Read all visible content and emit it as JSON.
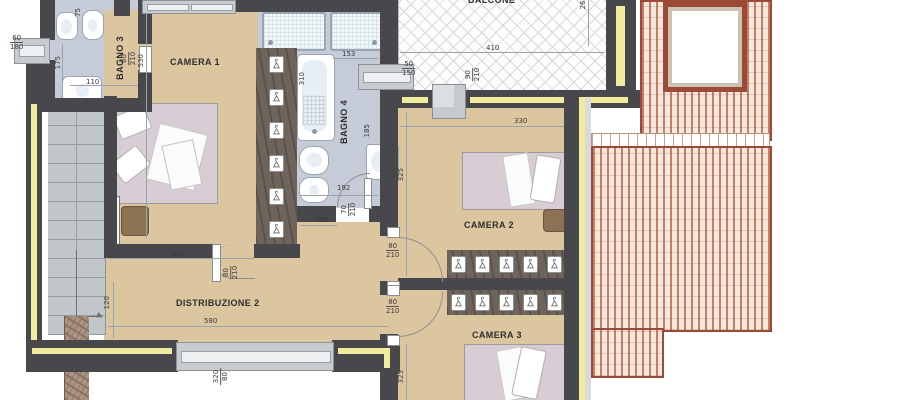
{
  "rooms": {
    "bagno3": "BAGNO 3",
    "camera1": "CAMERA 1",
    "bagno4": "BAGNO 4",
    "balcone": "BALCONE",
    "camera2": "CAMERA 2",
    "camera3": "CAMERA 3",
    "distribuzione2": "DISTRIBUZIONE 2"
  },
  "dims": {
    "win_bagno3": {
      "a": "60",
      "b": "180"
    },
    "wc_width": "75",
    "d175": "175",
    "door_bagno3": {
      "a": "60",
      "b": "210"
    },
    "d110": "110",
    "d530": "530",
    "d310": "310",
    "d153": "153",
    "win_bagno4": {
      "a": "50",
      "b": "150"
    },
    "d410": "410",
    "d260": "260",
    "door_balcone": {
      "a": "90",
      "b": "210"
    },
    "d330": "330",
    "d325_camera2": "325",
    "d185": "185",
    "d192": "192",
    "door_bagno4": {
      "a": "70",
      "b": "210"
    },
    "d195": "195",
    "d365": "365",
    "door_camera1": {
      "a": "80",
      "b": "210"
    },
    "door_camera2": {
      "a": "80",
      "b": "210"
    },
    "door_camera3": {
      "a": "80",
      "b": "210"
    },
    "d580": "580",
    "d120": "120",
    "win_distribuzione": {
      "a": "320",
      "b": "80"
    },
    "d325_camera3": "325"
  },
  "colors": {
    "wall": "#47474c",
    "insulation": "#f1eb9e",
    "room_floor": "#dcc6a0",
    "bath_floor": "#c5ccd8",
    "wardrobe": "#6f645c",
    "roof_tile": "#c77f63",
    "roof_field": "#f5e9df",
    "roof_border": "#9c4a38",
    "stairs": "#c0c6ca",
    "mattress": "#d9cdd5",
    "balcony_hatch": "#d8d8d8"
  }
}
